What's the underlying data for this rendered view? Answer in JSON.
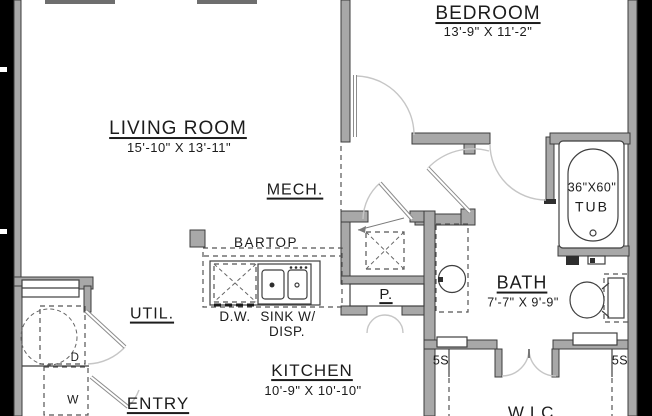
{
  "plan_title": "Apartment unit floor plan",
  "colors": {
    "paper": "#ffffff",
    "outside": "#000000",
    "wall_fill": "#a8a8a8",
    "wall_stroke": "#3c3c3c",
    "fixture_line": "#3f3f3f",
    "door_arc": "#c6c6c6",
    "text": "#1c1c1c"
  },
  "rooms": {
    "bedroom": {
      "label": "BEDROOM",
      "dims": "13'-9\" X 11'-2\""
    },
    "living_room": {
      "label": "LIVING ROOM",
      "dims": "15'-10\" X 13'-11\""
    },
    "mech": {
      "label": "MECH."
    },
    "bath": {
      "label": "BATH",
      "dims": "7'-7\" X 9'-9\""
    },
    "kitchen": {
      "label": "KITCHEN",
      "dims": "10'-9\" X 10'-10\""
    },
    "util": {
      "label": "UTIL."
    },
    "entry": {
      "label": "ENTRY"
    },
    "wic": {
      "label": "W.I.C."
    }
  },
  "fixtures": {
    "bartop": "BARTOP",
    "dishwasher": "D.W.",
    "sink_line1": "SINK W/",
    "sink_line2": "DISP.",
    "pantry": "P.",
    "tub_size": "36\"X60\"",
    "tub": "TUB",
    "shelves_left": "5S",
    "shelves_right": "5S",
    "washer": "W",
    "dryer": "D"
  }
}
